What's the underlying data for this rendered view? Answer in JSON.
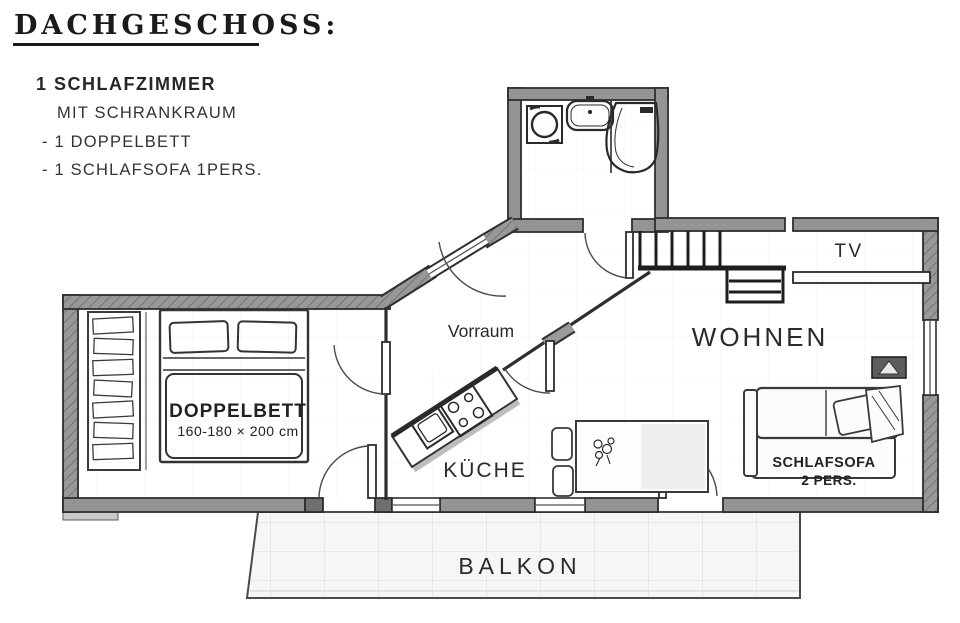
{
  "header": {
    "title": "DACHGESCHOSS:",
    "line1": "1 SCHLAFZIMMER",
    "line2": "MIT SCHRANKRAUM",
    "line3": "- 1 DOPPELBETT",
    "line4": "- 1 SCHLAFSOFA 1PERS."
  },
  "rooms": {
    "vorraum": "Vorraum",
    "wohnen": "WOHNEN",
    "kueche": "KÜCHE",
    "balkon": "BALKON"
  },
  "furniture": {
    "tv": "TV",
    "bed_label": "DOPPELBETT",
    "bed_size": "160-180 × 200 cm",
    "sofa_label": "SCHLAFSOFA",
    "sofa_capacity": "2 PERS."
  },
  "icons": {
    "washing_machine": "washing-machine-icon",
    "sink": "bathroom-sink-icon",
    "shower": "shower-icon",
    "stove": "stove-icon",
    "kitchen_sink": "kitchen-sink-icon",
    "plant": "plant-icon",
    "flowers": "table-flowers-icon"
  },
  "colors": {
    "wall": "#949494",
    "wall_dark": "#6f6f6f",
    "outline": "#2e2e2e",
    "text": "#1c1c1c",
    "balcony_fill": "#f6f6f4",
    "grid": "#dcdcdc"
  }
}
